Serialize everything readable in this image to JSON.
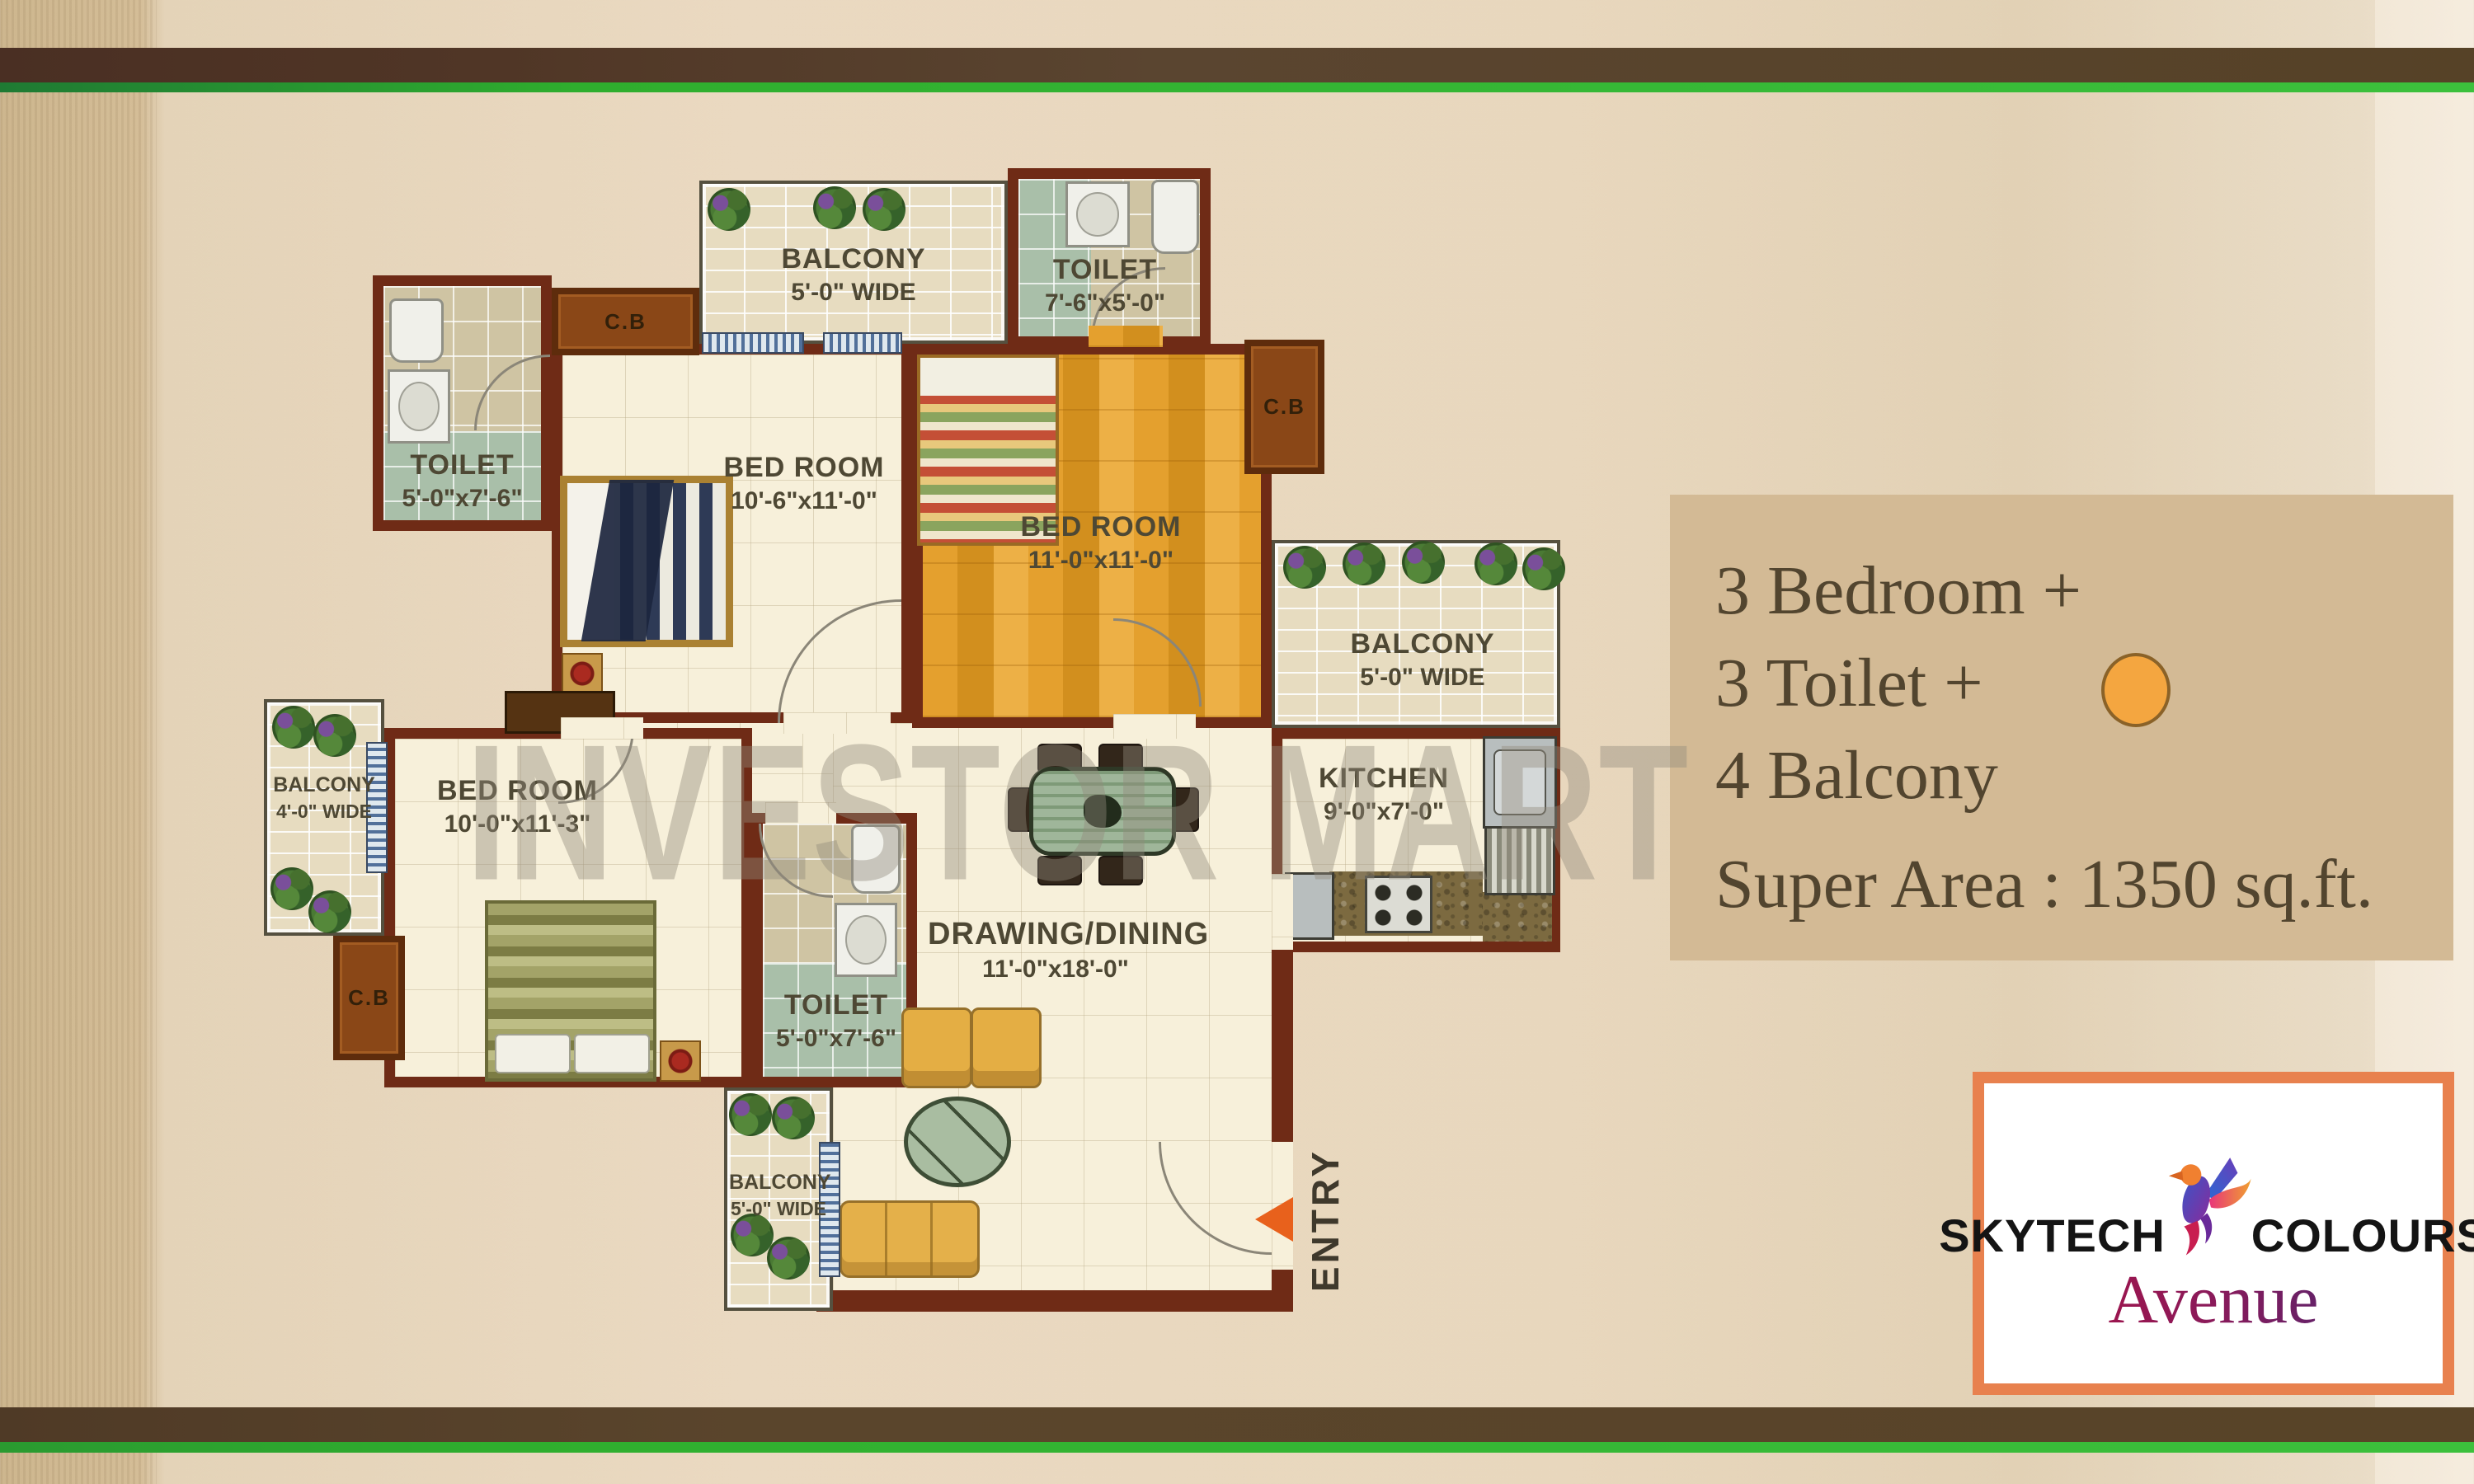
{
  "plan": {
    "watermark": "INVESTOR MART",
    "entry": {
      "label": "ENTRY"
    },
    "rooms": {
      "balcony_top": {
        "name": "BALCONY",
        "dims": "5'-0\" WIDE"
      },
      "toilet_top": {
        "name": "TOILET",
        "dims": "7'-6\"x5'-0\""
      },
      "toilet_left": {
        "name": "TOILET",
        "dims": "5'-0\"x7'-6\""
      },
      "bedroom_top_left": {
        "name": "BED ROOM",
        "dims": "10'-6\"x11'-0\""
      },
      "bedroom_top_right": {
        "name": "BED ROOM",
        "dims": "11'-0\"x11'-0\""
      },
      "balcony_right": {
        "name": "BALCONY",
        "dims": "5'-0\" WIDE"
      },
      "kitchen": {
        "name": "KITCHEN",
        "dims": "9'-0\"x7'-0\""
      },
      "balcony_left": {
        "name": "BALCONY",
        "dims": "4'-0\" WIDE"
      },
      "bedroom_bottom": {
        "name": "BED ROOM",
        "dims": "10'-0\"x11'-3\""
      },
      "toilet_bottom": {
        "name": "TOILET",
        "dims": "5'-0\"x7'-6\""
      },
      "drawing_dining": {
        "name": "DRAWING/DINING",
        "dims": "11'-0\"x18'-0\""
      },
      "balcony_bottom": {
        "name": "BALCONY",
        "dims": "5'-0\" WIDE"
      },
      "cupboard_top": {
        "label": "C.B"
      },
      "cupboard_right": {
        "label": "C.B"
      },
      "cupboard_bottom": {
        "label": "C.B"
      }
    }
  },
  "info_panel": {
    "lines": [
      "3 Bedroom +",
      "3 Toilet +",
      "4 Balcony"
    ],
    "super_area": "Super Area : 1350 sq.ft."
  },
  "logo": {
    "brand_left": "SKYTECH",
    "brand_right": "COLOURS",
    "sub_brand": "Avenue"
  },
  "colors": {
    "wall": "#6f2b16",
    "wood_floor": "#e09a28",
    "green_line": "#3cc03c",
    "logo_border": "#e8814e",
    "entry_arrow": "#e8611c",
    "highlight_circle": "#f4a640"
  }
}
